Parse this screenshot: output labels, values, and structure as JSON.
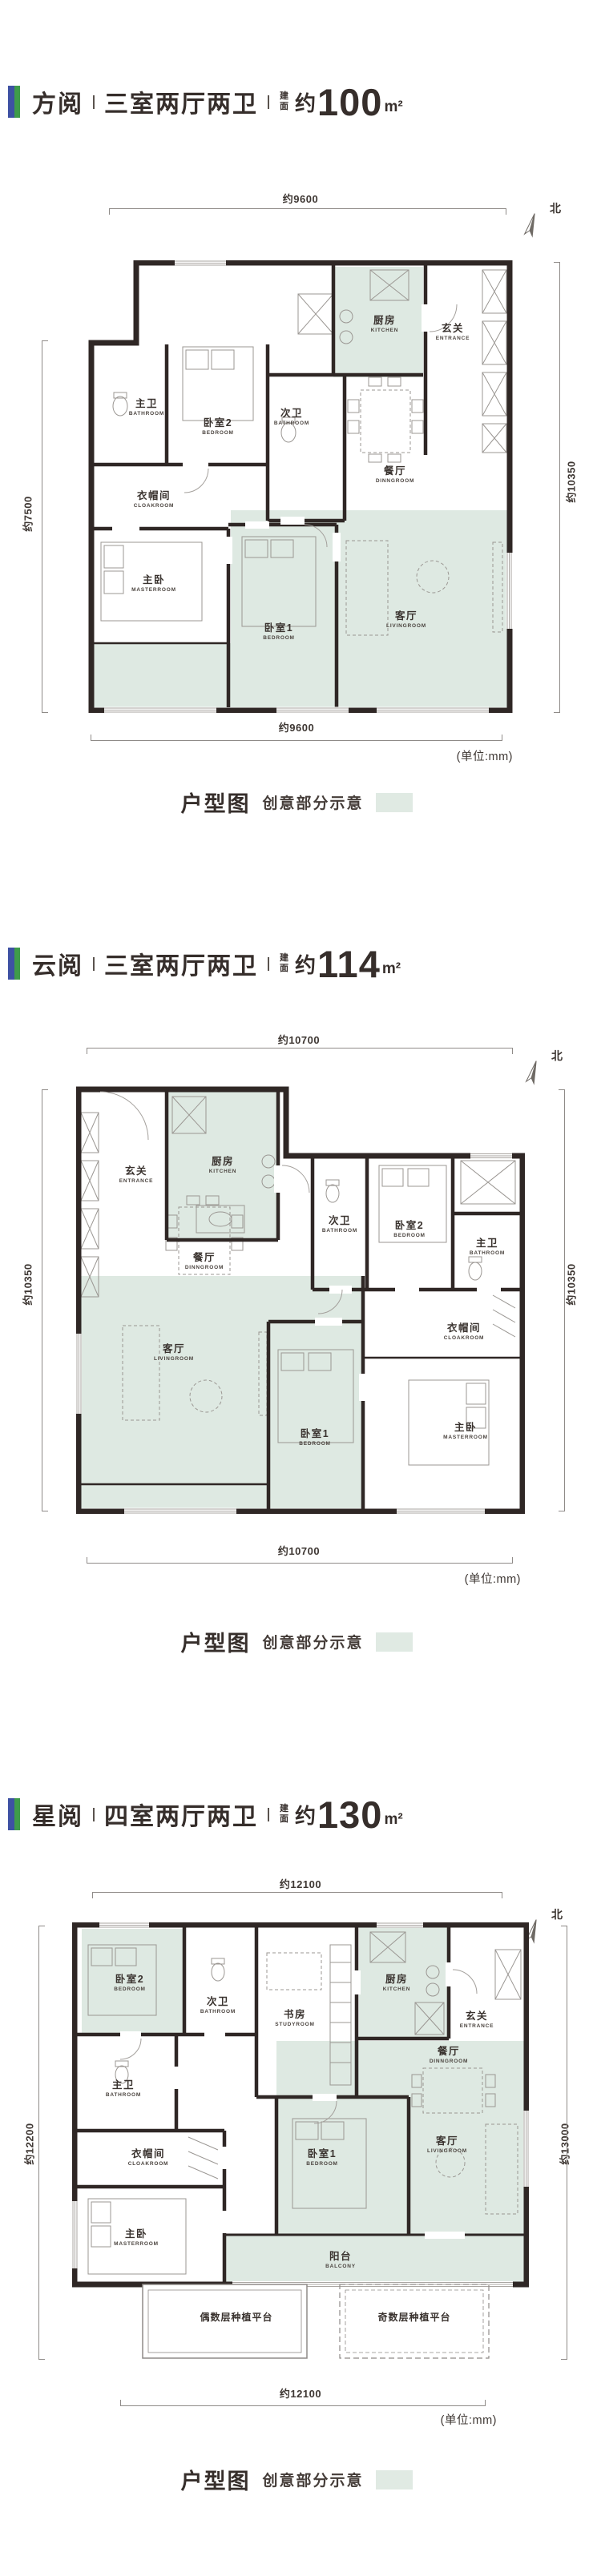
{
  "page": {
    "unit_note": "(单位:mm)",
    "compass_label": "北",
    "caption_title": "户型图",
    "caption_subtitle": "创意部分示意",
    "creative_fill_color": "#dee9e2",
    "accent_blue": "#3e51a3",
    "accent_green": "#3f9b4a",
    "wall_color": "#2f2725"
  },
  "plans": [
    {
      "name": "方阅",
      "layout": "三室两厅两卫",
      "area_label": "建面",
      "area_prefix": "约",
      "area_value": "100",
      "area_unit": "m²",
      "dims": {
        "top": "约9600",
        "bottom": "约9600",
        "left": "约7500",
        "right": "约10350"
      },
      "rooms": [
        {
          "cn": "厨房",
          "en": "KITCHEN"
        },
        {
          "cn": "玄关",
          "en": "ENTRANCE"
        },
        {
          "cn": "主卫",
          "en": "BATHROOM"
        },
        {
          "cn": "卧室2",
          "en": "BEDROOM"
        },
        {
          "cn": "次卫",
          "en": "BATHROOM"
        },
        {
          "cn": "衣帽间",
          "en": "CLOAKROOM"
        },
        {
          "cn": "餐厅",
          "en": "DINNGROOM"
        },
        {
          "cn": "主卧",
          "en": "MASTERROOM"
        },
        {
          "cn": "卧室1",
          "en": "BEDROOM"
        },
        {
          "cn": "客厅",
          "en": "LIVINGROOM"
        }
      ]
    },
    {
      "name": "云阅",
      "layout": "三室两厅两卫",
      "area_label": "建面",
      "area_prefix": "约",
      "area_value": "114",
      "area_unit": "m²",
      "dims": {
        "top": "约10700",
        "bottom": "约10700",
        "left": "约10350",
        "right": "约10350"
      },
      "rooms": [
        {
          "cn": "玄关",
          "en": "ENTRANCE"
        },
        {
          "cn": "厨房",
          "en": "KITCHEN"
        },
        {
          "cn": "次卫",
          "en": "BATHROOM"
        },
        {
          "cn": "卧室2",
          "en": "BEDROOM"
        },
        {
          "cn": "主卫",
          "en": "BATHROOM"
        },
        {
          "cn": "餐厅",
          "en": "DINNGROOM"
        },
        {
          "cn": "客厅",
          "en": "LIVINGROOM"
        },
        {
          "cn": "卧室1",
          "en": "BEDROOM"
        },
        {
          "cn": "衣帽间",
          "en": "CLOAKROOM"
        },
        {
          "cn": "主卧",
          "en": "MASTERROOM"
        }
      ]
    },
    {
      "name": "星阅",
      "layout": "四室两厅两卫",
      "area_label": "建面",
      "area_prefix": "约",
      "area_value": "130",
      "area_unit": "m²",
      "dims": {
        "top": "约12100",
        "bottom": "约12100",
        "left": "约12200",
        "right": "约13000"
      },
      "rooms": [
        {
          "cn": "卧室2",
          "en": "BEDROOM"
        },
        {
          "cn": "次卫",
          "en": "BATHROOM"
        },
        {
          "cn": "书房",
          "en": "STUDYROOM"
        },
        {
          "cn": "厨房",
          "en": "KITCHEN"
        },
        {
          "cn": "玄关",
          "en": "ENTRANCE"
        },
        {
          "cn": "餐厅",
          "en": "DINNGROOM"
        },
        {
          "cn": "主卫",
          "en": "BATHROOM"
        },
        {
          "cn": "衣帽间",
          "en": "CLOAKROOM"
        },
        {
          "cn": "主卧",
          "en": "MASTERROOM"
        },
        {
          "cn": "卧室1",
          "en": "BEDROOM"
        },
        {
          "cn": "客厅",
          "en": "LIVINGROOM"
        },
        {
          "cn": "阳台",
          "en": "BALCONY"
        }
      ],
      "platforms": [
        "偶数层种植平台",
        "奇数层种植平台"
      ]
    }
  ]
}
